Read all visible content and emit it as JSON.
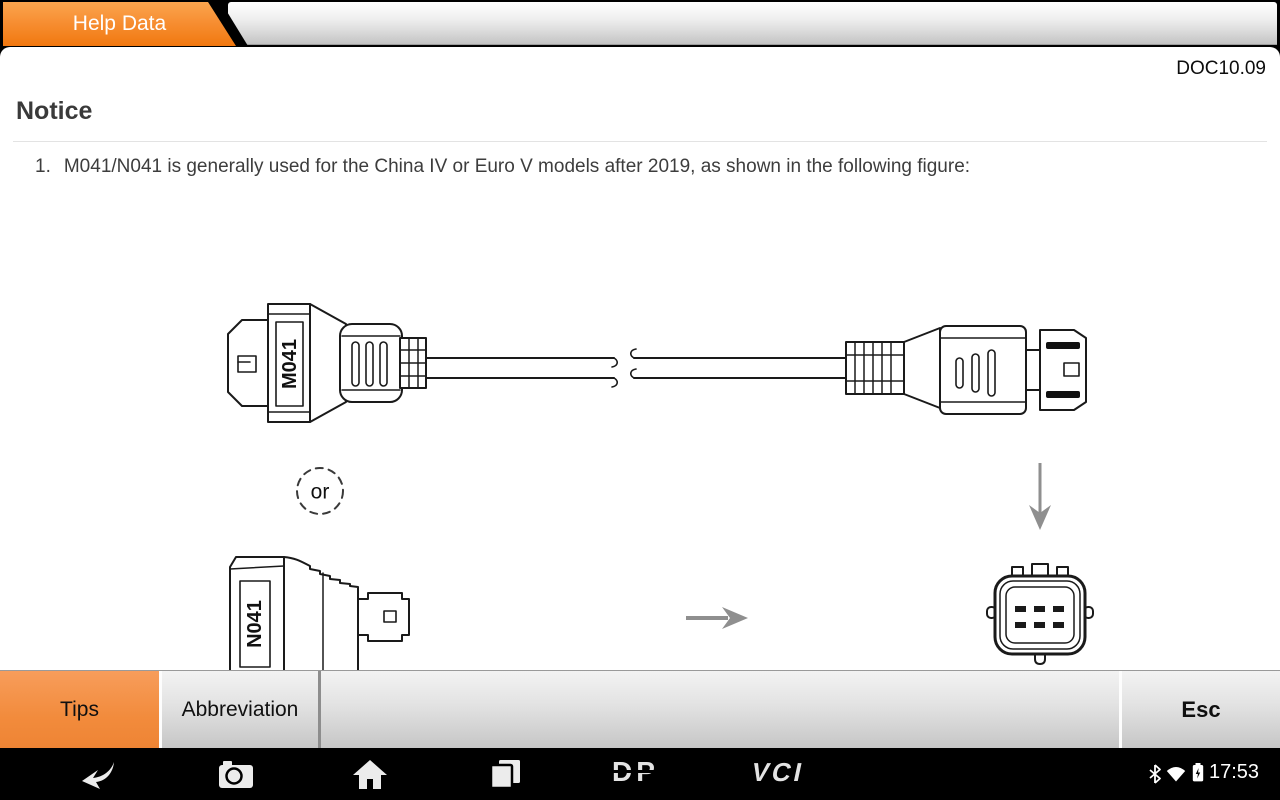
{
  "header": {
    "tab_label": "Help Data",
    "doc_code": "DOC10.09"
  },
  "content": {
    "title": "Notice",
    "items": [
      {
        "number": "1.",
        "text": "M041/N041 is generally used for the China IV or Euro V models after 2019, as shown in the following figure:"
      }
    ]
  },
  "diagram": {
    "top_connector_label": "M041",
    "bottom_adapter_label": "N041",
    "or_label": "or",
    "elements": [
      "m041-obd-connector",
      "cable-with-break",
      "right-plug-connector",
      "or-badge",
      "down-arrow",
      "n041-adapter",
      "right-arrow",
      "6-pin-socket"
    ]
  },
  "bottom_bar": {
    "tips_label": "Tips",
    "abbreviation_label": "Abbreviation",
    "esc_label": "Esc",
    "active_button": "Tips"
  },
  "nav_bar": {
    "icons": [
      "back",
      "camera",
      "home",
      "recents"
    ],
    "dp_logo": "DP",
    "vci_logo": "VCI",
    "status_icons": [
      "bluetooth",
      "wifi",
      "battery-charging"
    ],
    "time": "17:53"
  },
  "colors": {
    "tab_orange_top": "#FBA54E",
    "tab_orange_bottom": "#F1780F",
    "active_button_orange": "#F28B3C",
    "bar_gray": "#D9D9D9",
    "text_dark": "#3D3D3D",
    "arrow_gray": "#8F8F8F",
    "nav_black": "#000000"
  }
}
